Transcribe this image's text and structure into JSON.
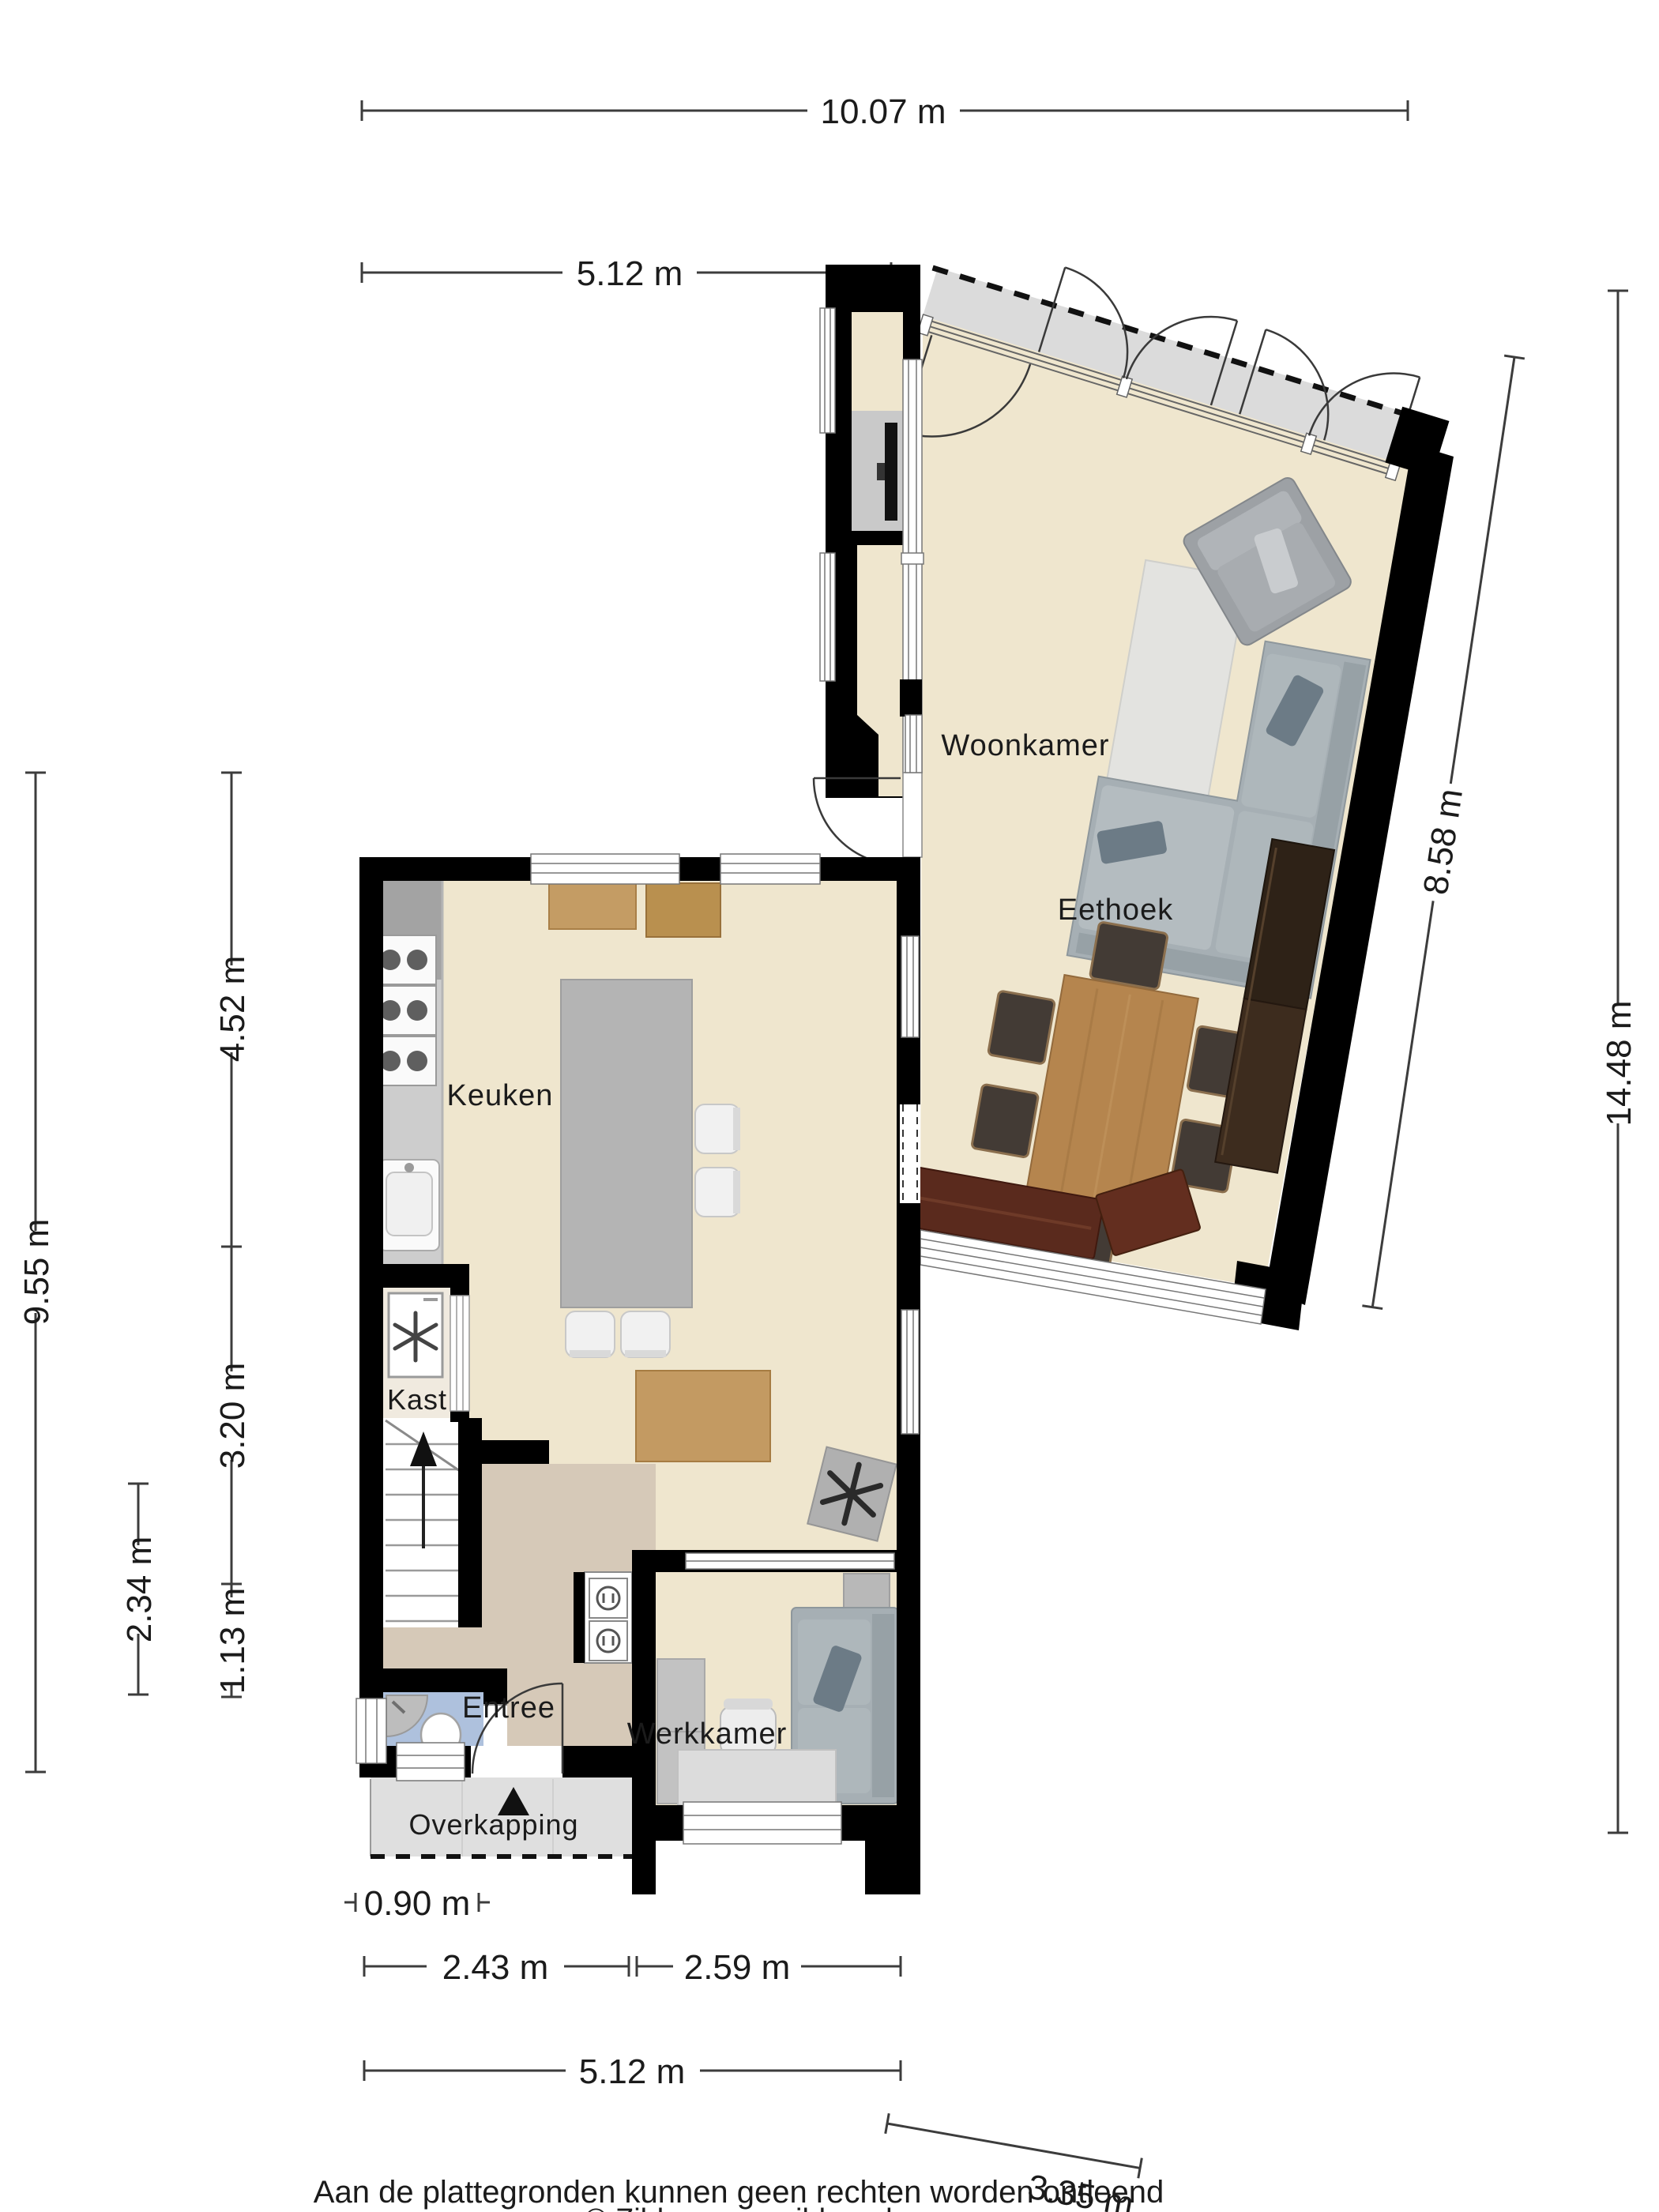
{
  "plan": {
    "type": "floorplan",
    "rooms": {
      "woonkamer": {
        "label": "Woonkamer"
      },
      "eethoek": {
        "label": "Eethoek"
      },
      "keuken": {
        "label": "Keuken"
      },
      "kast": {
        "label": "Kast"
      },
      "entree": {
        "label": "Entree"
      },
      "werkkamer": {
        "label": "Werkkamer"
      },
      "overkapping": {
        "label": "Overkapping"
      }
    },
    "dimensions": {
      "top_total": {
        "label": "10.07 m"
      },
      "top_keuken": {
        "label": "5.12 m"
      },
      "top_woonkamer": {
        "label": "4.71 m"
      },
      "right_total": {
        "label": "14.48 m"
      },
      "right_woonkamer": {
        "label": "8.58 m"
      },
      "left_total": {
        "label": "9.55 m"
      },
      "left_keuken": {
        "label": "4.52 m"
      },
      "left_entree": {
        "label": "3.20 m"
      },
      "left_toilet": {
        "label": "2.34 m"
      },
      "left_overkapping": {
        "label": "1.13 m"
      },
      "bottom_overkapping": {
        "label": "0.90 m"
      },
      "bottom_entree": {
        "label": "2.43 m"
      },
      "bottom_werkkamer": {
        "label": "2.59 m"
      },
      "bottom_total": {
        "label": "5.12 m"
      },
      "bottom_right": {
        "label": "3.35 m"
      }
    },
    "icons": {
      "north_arrow": "north-arrow",
      "washing_machine": "washing-machine-icon",
      "ventilation_unit": "ventilation-icon",
      "stairs_up_arrow": "stairs-up-arrow"
    },
    "colors": {
      "floor_main": "#EFE6CE",
      "floor_entree": "#D6C9B8",
      "floor_toilet": "#AEC1DD",
      "wall": "#000000",
      "terrace": "#DBDBDB",
      "overkapping": "#DFDFDF",
      "kitchen_island": "#B4B4B4",
      "counter": "#CDCDCD",
      "sofa": "#A6AFB4",
      "dining_table": "#B5854E",
      "sideboard": "#2E2217",
      "bench": "#5A2A1D"
    }
  },
  "footer": {
    "disclaimer": "Aan de plattegronden kunnen geen rechten worden ontleend",
    "copyright": "© Zibber www.zibber.nl"
  }
}
